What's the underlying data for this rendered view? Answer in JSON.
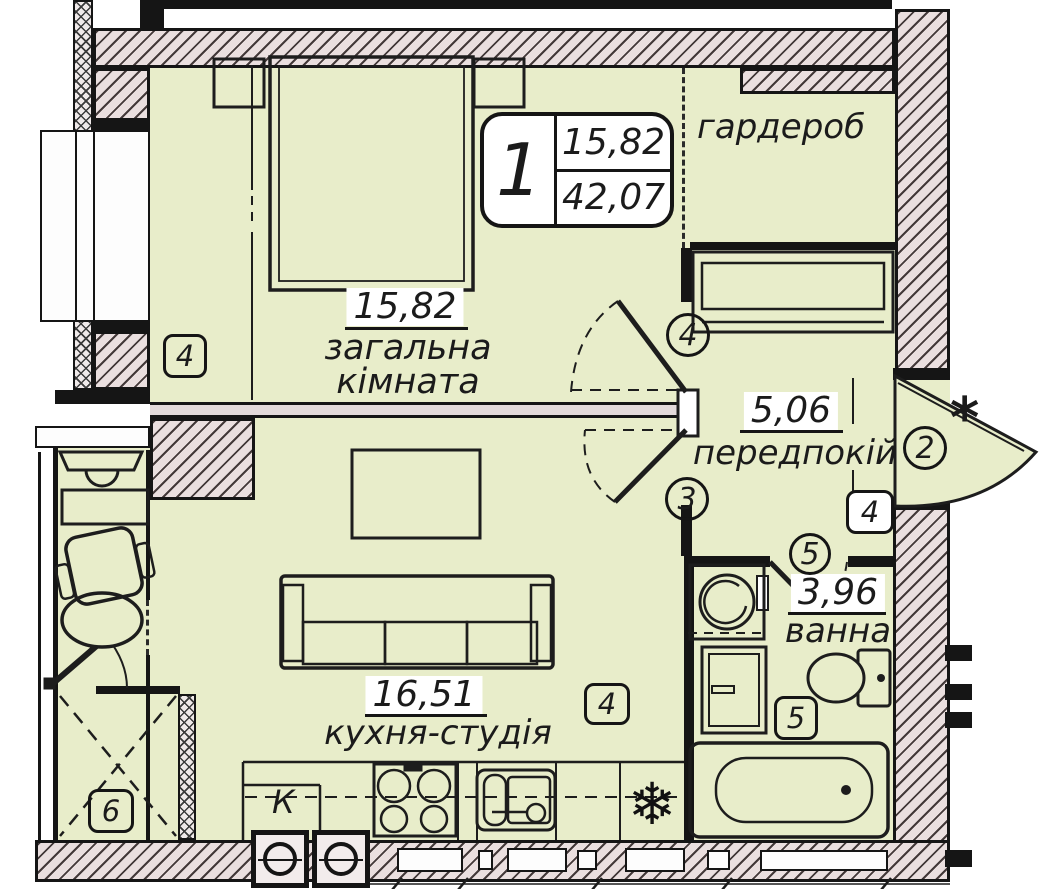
{
  "apartment": {
    "type_label": "1",
    "living_area": "15,82",
    "total_area": "42,07"
  },
  "rooms": {
    "wardrobe": {
      "name": "гардероб"
    },
    "living": {
      "area": "15,82",
      "name_line1": "загальна",
      "name_line2": "кімната"
    },
    "hallway": {
      "area": "5,06",
      "name": "передпокій"
    },
    "bathroom": {
      "area": "3,96",
      "name": "ванна"
    },
    "kitchen": {
      "area": "16,51",
      "name": "кухня-студія"
    }
  },
  "markers": {
    "door_living": "4",
    "door_kitchen": "3",
    "door_entrance": "2",
    "entrance_star": "*",
    "door_bathroom": "5",
    "window_living": "4",
    "window_hallway": "4",
    "window_kitchen": "4",
    "window_bathroom": "5",
    "shaft": "6"
  },
  "labels": {
    "kitchen_vent": "К",
    "fridge_snowflake": "❄"
  },
  "colors": {
    "floor": "#e8edca",
    "wall_fill": "#eadfdf",
    "line": "#1d1d1d"
  }
}
